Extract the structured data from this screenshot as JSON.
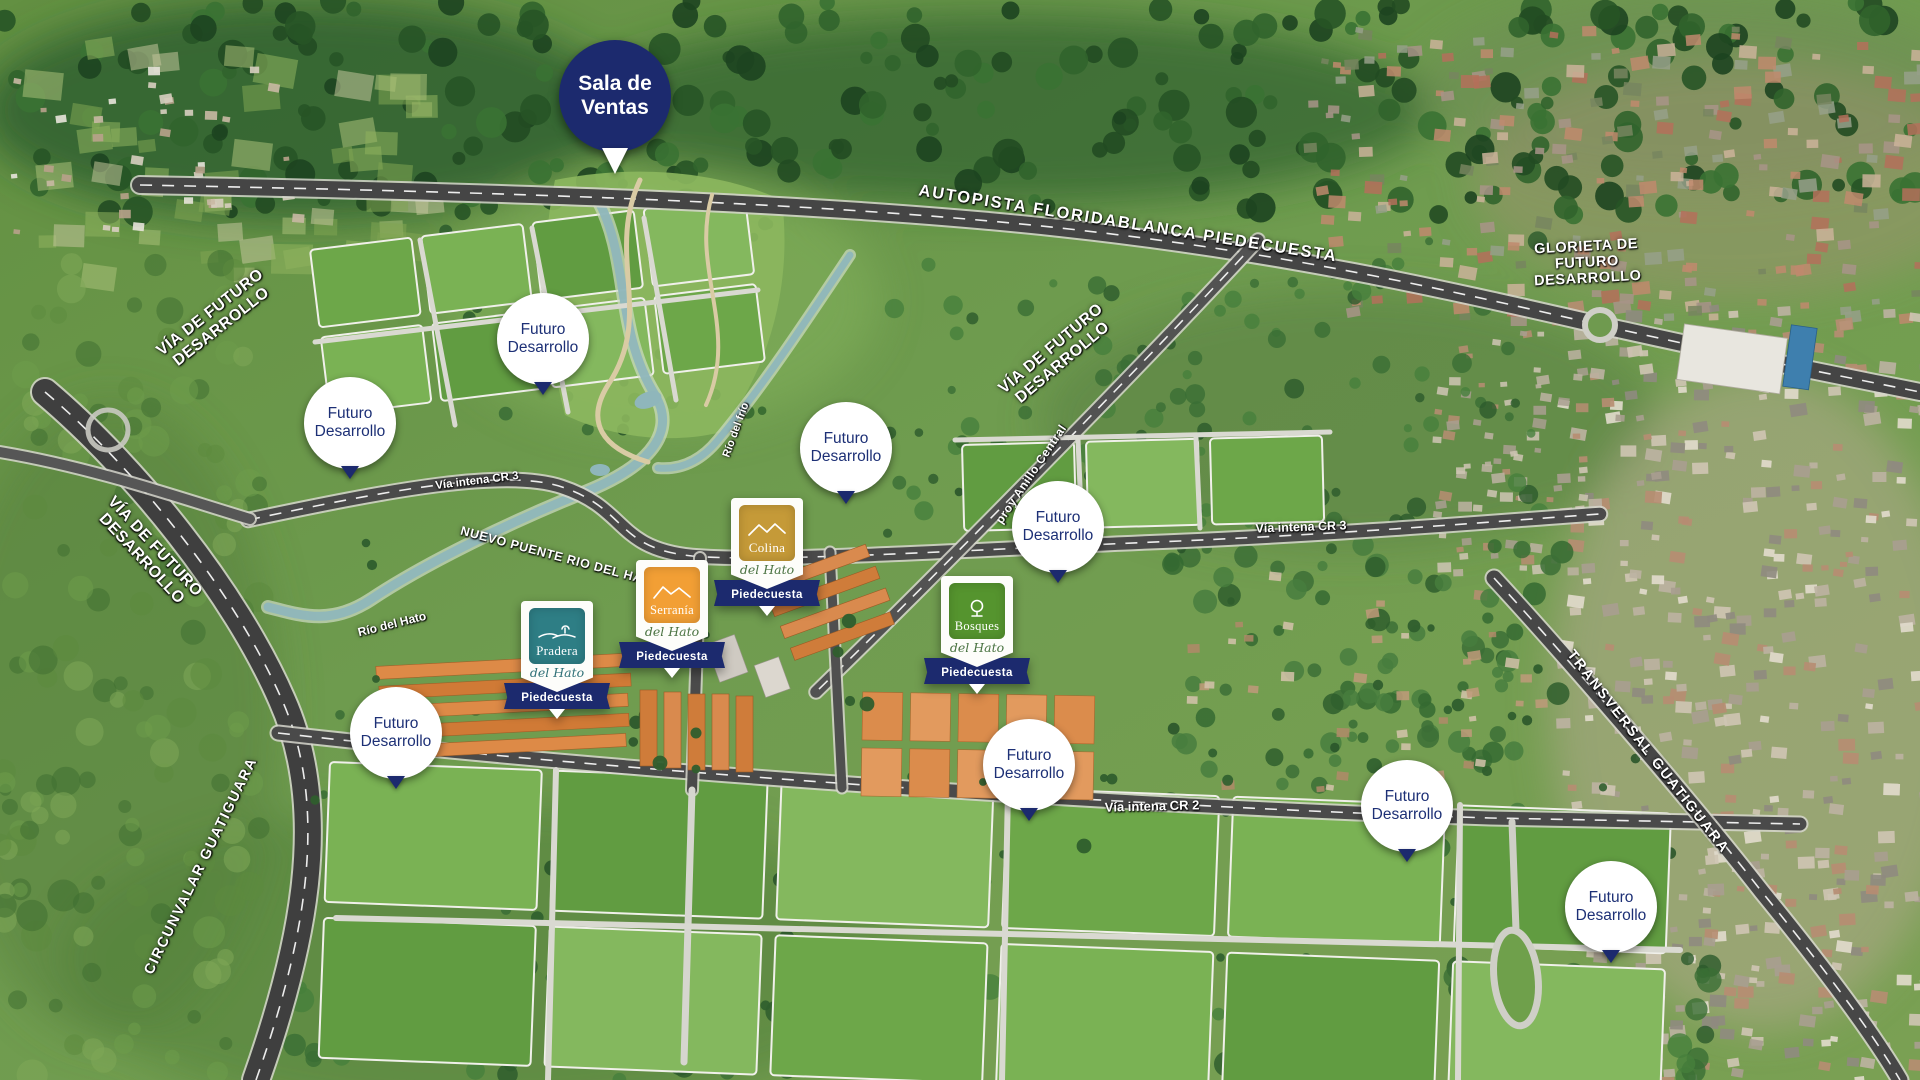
{
  "markers": {
    "sala_de_ventas": "Sala de Ventas",
    "futuro_desarrollo": "Futuro Desarrollo"
  },
  "projects": {
    "colina": {
      "name": "Colina",
      "script": "del Hato",
      "city": "Piedecuesta"
    },
    "serrania": {
      "name": "Serranía",
      "script": "del Hato",
      "city": "Piedecuesta"
    },
    "pradera": {
      "name": "Pradera",
      "script": "del Hato",
      "city": "Piedecuesta"
    },
    "bosques": {
      "name": "Bosques",
      "script": "del Hato",
      "city": "Piedecuesta"
    }
  },
  "roads": {
    "autopista": "AUTOPISTA FLORIDABLANCA PIEDECUESTA",
    "glorieta": "GLORIETA DE FUTURO DESARROLLO",
    "via_futuro": "VÍA DE FUTURO DESARROLLO",
    "circunvalar": "CIRCUNVALAR GUATIGUARA",
    "transversal": "TRANSVERSAL GUATIGUARA",
    "anillo": "proy Anillo Central",
    "cr3_oeste": "Vía intena CR 3",
    "cr3": "Vía intena CR 3",
    "cr2": "Vía intena CR 2",
    "puente": "NUEVO PUENTE RIO DEL HATO"
  },
  "rivers": {
    "hato": "Río del Hato",
    "frio": "Río del frío"
  },
  "colors": {
    "navy": "#1c2a6e",
    "colina": "#c59a38",
    "serrania": "#f29f35",
    "pradera": "#2e7e85",
    "bosques": "#55942e"
  }
}
